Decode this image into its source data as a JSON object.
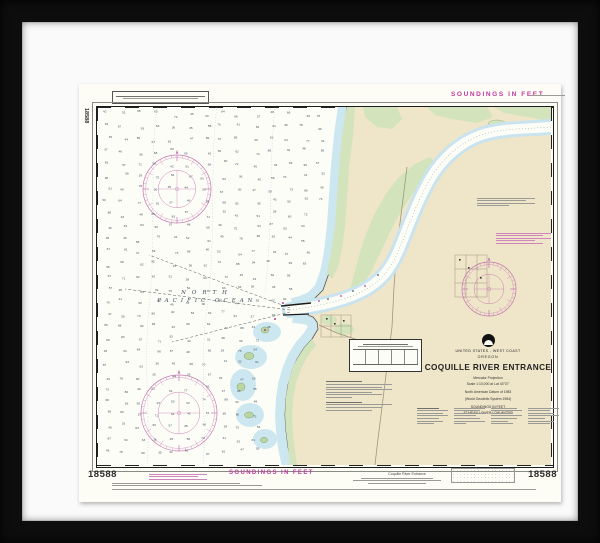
{
  "artwork": {
    "kind": "framed NOAA nautical chart",
    "colors": {
      "frame": "#0d0d0d",
      "mat": "#fafafa",
      "paper": "#fdfcf5",
      "land": "#efe5c9",
      "marsh": "#d3e3bc",
      "shallow_water": "#cde7f0",
      "magenta_accent": "#c2399f"
    }
  },
  "chart": {
    "number": "18588",
    "number_left_vertical": "18588",
    "number_bottom_left": "18588",
    "number_bottom_right": "18588",
    "soundings_label_top": "SOUNDINGS IN FEET",
    "soundings_label_bottom": "SOUNDINGS IN FEET",
    "ocean_label": {
      "line1": "NORTH",
      "line2": "PACIFIC OCEAN"
    },
    "title_block": {
      "country": "UNITED STATES - WEST COAST",
      "state": "OREGON",
      "title": "COQUILLE RIVER ENTRANCE",
      "projection": "Mercator Projection",
      "scale": "Scale 1:10,000 at Lat 43°07'",
      "datum": "North American Datum of 1983",
      "datum_alt": "(World Geodetic System 1984)",
      "soundings_unit": "SOUNDINGS IN FEET",
      "soundings_datum": "AT MEAN LOWER LOW WATER"
    },
    "caption_bottom_right": "Coquille River Entrance",
    "soundings_values": [
      42,
      51,
      38,
      60,
      72,
      45,
      33,
      84,
      96,
      57,
      48,
      66,
      39,
      75,
      54,
      87,
      93,
      63,
      36,
      45,
      58,
      70,
      41,
      52,
      61,
      49,
      78,
      90,
      35,
      44,
      55,
      67,
      81,
      47,
      59,
      73,
      86,
      40,
      53,
      64,
      77,
      91,
      37,
      46,
      56,
      68,
      82,
      95,
      43,
      50,
      62,
      74,
      88,
      34,
      48,
      69,
      83,
      57,
      71,
      92
    ]
  }
}
